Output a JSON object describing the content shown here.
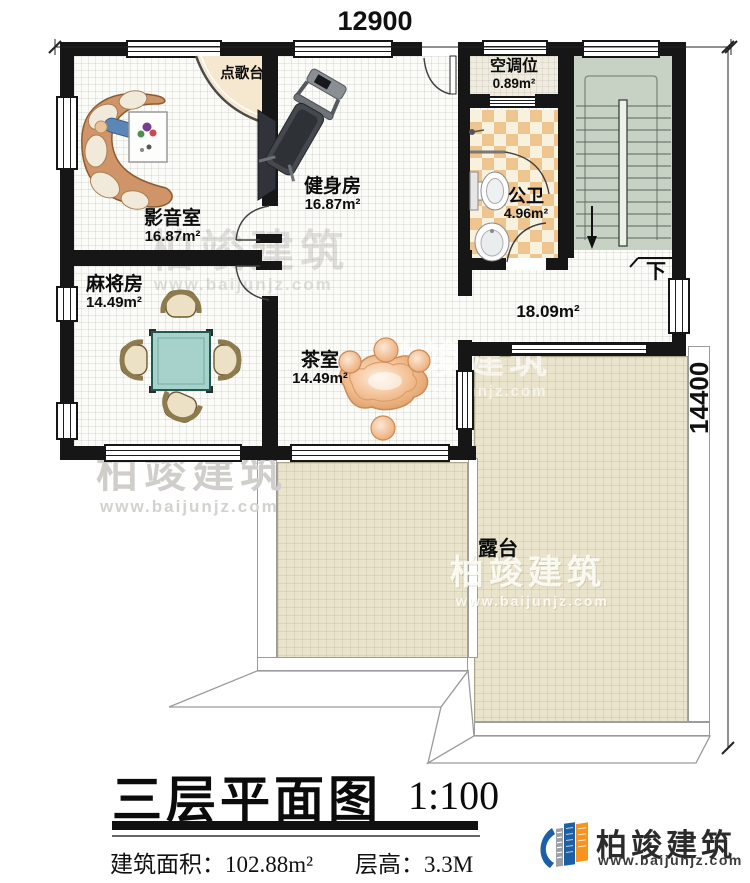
{
  "plan": {
    "dimensions": {
      "top": "12900",
      "right": "14400"
    },
    "rooms": {
      "media": {
        "name": "影音室",
        "area": "16.87m²"
      },
      "gym": {
        "name": "健身房",
        "area": "16.87m²"
      },
      "mahjong": {
        "name": "麻将房",
        "area": "14.49m²"
      },
      "tea": {
        "name": "茶室",
        "area": "14.49m²"
      },
      "bath": {
        "name": "公卫",
        "area": "4.96m²"
      },
      "ac": {
        "name": "空调位",
        "area": "0.89m²"
      },
      "hall": {
        "area": "18.09m²"
      },
      "terrace": {
        "name": "露台"
      },
      "karaoke": {
        "name": "点歌台"
      }
    },
    "stairs": {
      "down_label": "下"
    }
  },
  "title_block": {
    "title": "三层平面图",
    "scale": "1:100",
    "area_label": "建筑面积：",
    "area_value": "102.88m²",
    "floor_height_label": "层高：",
    "floor_height_value": "3.3M"
  },
  "logo": {
    "name": "柏竣建筑",
    "website": "www.baijunjz.com"
  },
  "watermark": {
    "name": "柏竣建筑",
    "website": "www.baijunjz.com"
  },
  "colors": {
    "wall": "#161616",
    "stairs_floor": "#c8d2c4",
    "bath_tile": "#eec48f",
    "terrace_floor": "#eae4cd",
    "mahjong_table": "#a6d2cb",
    "logo_blue": "#1b5fa8",
    "logo_orange": "#f7941d"
  }
}
